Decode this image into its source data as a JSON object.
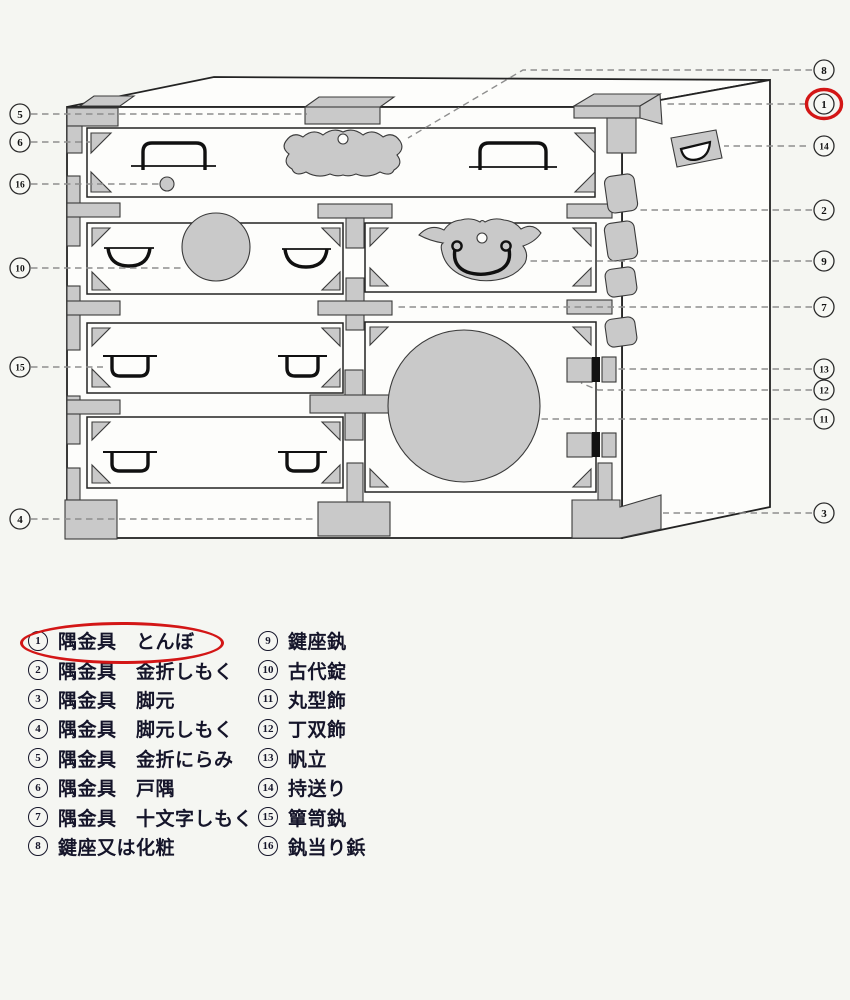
{
  "diagram": {
    "callout_numbers": {
      "left": [
        "5",
        "6",
        "16",
        "10",
        "15",
        "4"
      ],
      "right": [
        "8",
        "1",
        "14",
        "2",
        "9",
        "7",
        "13",
        "12",
        "11",
        "3"
      ]
    },
    "highlighted_callout": "1"
  },
  "legend": {
    "col1": [
      {
        "num": "1",
        "label": "隅金具　とんぼ"
      },
      {
        "num": "2",
        "label": "隅金具　金折しもく"
      },
      {
        "num": "3",
        "label": "隅金具　脚元"
      },
      {
        "num": "4",
        "label": "隅金具　脚元しもく"
      },
      {
        "num": "5",
        "label": "隅金具　金折にらみ"
      },
      {
        "num": "6",
        "label": "隅金具　戸隅"
      },
      {
        "num": "7",
        "label": "隅金具　十文字しもく"
      },
      {
        "num": "8",
        "label": "鍵座又は化粧"
      }
    ],
    "col2": [
      {
        "num": "9",
        "label": "鍵座釻"
      },
      {
        "num": "10",
        "label": "古代錠"
      },
      {
        "num": "11",
        "label": "丸型飾"
      },
      {
        "num": "12",
        "label": "丁双飾"
      },
      {
        "num": "13",
        "label": "帆立"
      },
      {
        "num": "14",
        "label": "持送り"
      },
      {
        "num": "15",
        "label": "簞笥釻"
      },
      {
        "num": "16",
        "label": "釻当り鋲"
      }
    ]
  },
  "colors": {
    "fitting_gray": "#c9c9c9",
    "line": "#232323",
    "leader_gray": "#8e8e8e",
    "highlight_red": "#d31616",
    "paper": "#f5f6f2"
  }
}
